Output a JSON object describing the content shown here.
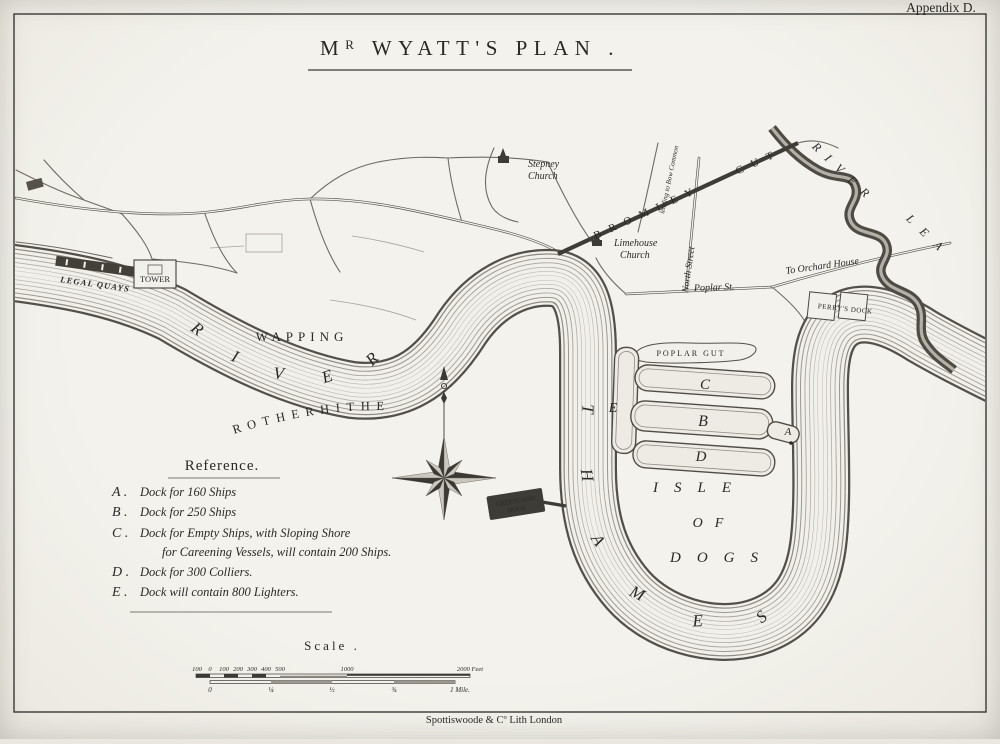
{
  "page": {
    "appendix": "Appendix D.",
    "imprint": "Spottiswoode & Cº Lith London"
  },
  "title": {
    "m": "M",
    "r": "R",
    "rest": " WYATT'S PLAN ."
  },
  "map": {
    "river_upper": "RIVER",
    "thames": "THAMES",
    "lea_river": "RIVER",
    "lea": "LEA",
    "wapping": "WAPPING",
    "rotherhithe": "ROTHERHITHE",
    "isle1": "ISLE",
    "isle2": "OF",
    "isle3": "DOGS",
    "bromley_cut": "BROMLEY CUT",
    "north_street": "North Street",
    "leading_bow": "leading to Bow Common",
    "poplar_st": "Poplar St.",
    "orchard": "To Orchard House",
    "perrys_dock": "PERRY'S DOCK",
    "poplar_gut": "POPLAR GUT",
    "greenland1": "GREENLAND",
    "greenland2": "DOCK",
    "stepney1": "Stepney",
    "stepney2": "Church",
    "limehouse1": "Limehouse",
    "limehouse2": "Church",
    "tower": "TOWER",
    "legal_quays": "LEGAL QUAYS",
    "dock_a": "A",
    "dock_b": "B",
    "dock_c": "C",
    "dock_d": "D",
    "dock_e": "E"
  },
  "reference": {
    "title": "Reference.",
    "items": [
      {
        "key": "A .",
        "text": "Dock for 160 Ships"
      },
      {
        "key": "B .",
        "text": "Dock for 250 Ships"
      },
      {
        "key": "C .",
        "text": "Dock for Empty Ships, with Sloping Shore"
      },
      {
        "key": "",
        "text": "for Careening Vessels, will contain 200 Ships."
      },
      {
        "key": "D .",
        "text": "Dock for 300 Colliers."
      },
      {
        "key": "E .",
        "text": "Dock will contain 800 Lighters."
      }
    ]
  },
  "scale": {
    "title": "Scale .",
    "feet_ticks": [
      "100",
      "0",
      "100",
      "200",
      "300",
      "400",
      "500",
      "1000",
      "2000 Feet"
    ],
    "mile_ticks": [
      "0",
      "¼",
      "½",
      "¾",
      "1 Mile."
    ]
  }
}
